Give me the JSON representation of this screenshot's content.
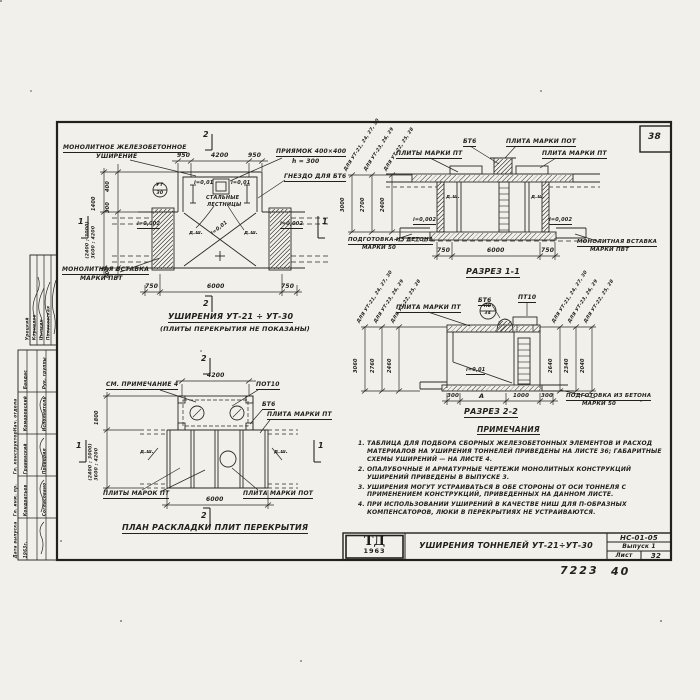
{
  "sheet": {
    "page_box": "38",
    "doc_number": "НС-01-05",
    "issue": "Выпуск 1",
    "sheet_word": "Лист",
    "sheet_number": "32",
    "logo_top": "ТД",
    "logo_year": "1963",
    "title": "Уширения тоннелей УТ-21÷УТ-30",
    "footer_code": "7223",
    "footer_num": "40"
  },
  "left_stamp": {
    "visas": [
      "Урецкий",
      "Корнилов",
      "Цыпкин",
      "Поляковская"
    ],
    "roles_mgmt": [
      "Нач. отдела",
      "Гл. конструктор",
      "Гл. инж. пр.",
      "Дата выпуска"
    ],
    "names_mgmt": [
      "Бандас",
      "Комаровский",
      "Гравинский",
      "Кондратьев",
      "1963г."
    ],
    "roles_team": [
      "Рук. группы",
      "Исполнитель",
      "Проверил",
      "Согласовано"
    ]
  },
  "plan": {
    "title": "Уширения УТ-21 ÷ УТ-30",
    "subtitle": "(Плиты перекрытия не показаны)",
    "lbl_monolith_1": "Монолитное железобетонное",
    "lbl_monolith_2": "уширение",
    "lbl_pit_1": "Приямок 400×400",
    "lbl_pit_2": "h = 300",
    "lbl_socket": "Гнездо для БТ6",
    "lbl_ladders_1": "Стальные",
    "lbl_ladders_2": "лестницы",
    "lbl_insert_1": "Монолитная вставка",
    "lbl_insert_2": "марки ПВТ",
    "marker_top": "УТ",
    "marker_bottom": "30",
    "slope_small": "i=0,01",
    "slope_edge": "i=0,002",
    "joint": "д.ш.",
    "dims_top": [
      "950",
      "4200",
      "950"
    ],
    "dims_bottom": [
      "750",
      "6000",
      "750"
    ],
    "dims_left": [
      "400",
      "1400",
      "300",
      "(2400 ; 3000)",
      "3600 ; 4200",
      "600"
    ],
    "sec_mark_2": "2",
    "sec_mark_1": "1"
  },
  "sec1": {
    "caption": "Разрез 1-1",
    "lbl_bt6": "БТ6",
    "lbl_pot": "Плита марки ПОТ",
    "lbl_pt_l": "Плиты марки ПТ",
    "lbl_pt_r": "Плита марки ПТ",
    "lbl_insert_1": "Монолитная вставка",
    "lbl_insert_2": "марки ПВТ",
    "lbl_prep_1": "Подготовка из бетона",
    "lbl_prep_2": "марки 50",
    "joint": "д.ш.",
    "slope": "i=0,002",
    "dims_bottom": [
      "750",
      "6000",
      "750"
    ],
    "chains": [
      {
        "label": "Для УТ-21, 24, 27, 30",
        "value": "3000"
      },
      {
        "label": "Для УТ-23, 26, 29",
        "value": "2700"
      },
      {
        "label": "Для УТ-22, 25, 28",
        "value": "2400"
      }
    ]
  },
  "sec2": {
    "caption": "Разрез 2-2",
    "lbl_pt": "Плита марки ПТ",
    "lbl_bt6": "БТ6",
    "lbl_pt10": "ПТ10",
    "marker_top": "ПВ",
    "marker_bottom": "34",
    "slope": "i=0,01",
    "lbl_prep_1": "Подготовка из бетона",
    "lbl_prep_2": "марки 50",
    "dims_bottom": [
      "300",
      "А",
      "1000",
      "300"
    ],
    "chains_left": [
      {
        "label": "Для УТ-21, 24, 27, 30",
        "value": "3060"
      },
      {
        "label": "Для УТ-23, 26, 29",
        "value": "2760"
      },
      {
        "label": "Для УТ-22, 25, 28",
        "value": "2460"
      }
    ],
    "chains_right": [
      {
        "label": "Для УТ-21, 24, 27, 30",
        "value": "2640"
      },
      {
        "label": "Для УТ-23, 26, 29",
        "value": "2340"
      },
      {
        "label": "Для УТ-22, 25, 28",
        "value": "2040"
      }
    ]
  },
  "plan2": {
    "caption": "План раскладки плит перекрытия",
    "lbl_note": "См. примечание 4",
    "lbl_pot10": "ПОТ10",
    "lbl_bt6": "БТ6",
    "lbl_pt": "Плита марки ПТ",
    "lbl_pts": "Плиты марок ПТ",
    "lbl_pot": "Плита марки ПОТ",
    "joint": "д.ш.",
    "dim_top": "4200",
    "dim_bottom": "6000",
    "dims_left": [
      "1800",
      "(2400 ; 3000)",
      "3600 ; 4200"
    ],
    "sec_mark_2": "2",
    "sec_mark_1": "1"
  },
  "notes": {
    "title": "Примечания",
    "items": [
      "1. Таблица для подбора сборных железобетонных элементов и расход материалов на уширения тоннелей приведены на листе 36; габаритные схемы уширений — на листе 4.",
      "2. Опалубочные и арматурные чертежи монолитных конструкций уширений приведены в выпуске 3.",
      "3. Уширения могут устраиваться в обе стороны от оси тоннеля с применением конструкций, приведенных на данном листе.",
      "4. При использовании уширений в качестве ниш для П-образных компенсаторов, люки в перекрытиях не устраиваются."
    ]
  }
}
